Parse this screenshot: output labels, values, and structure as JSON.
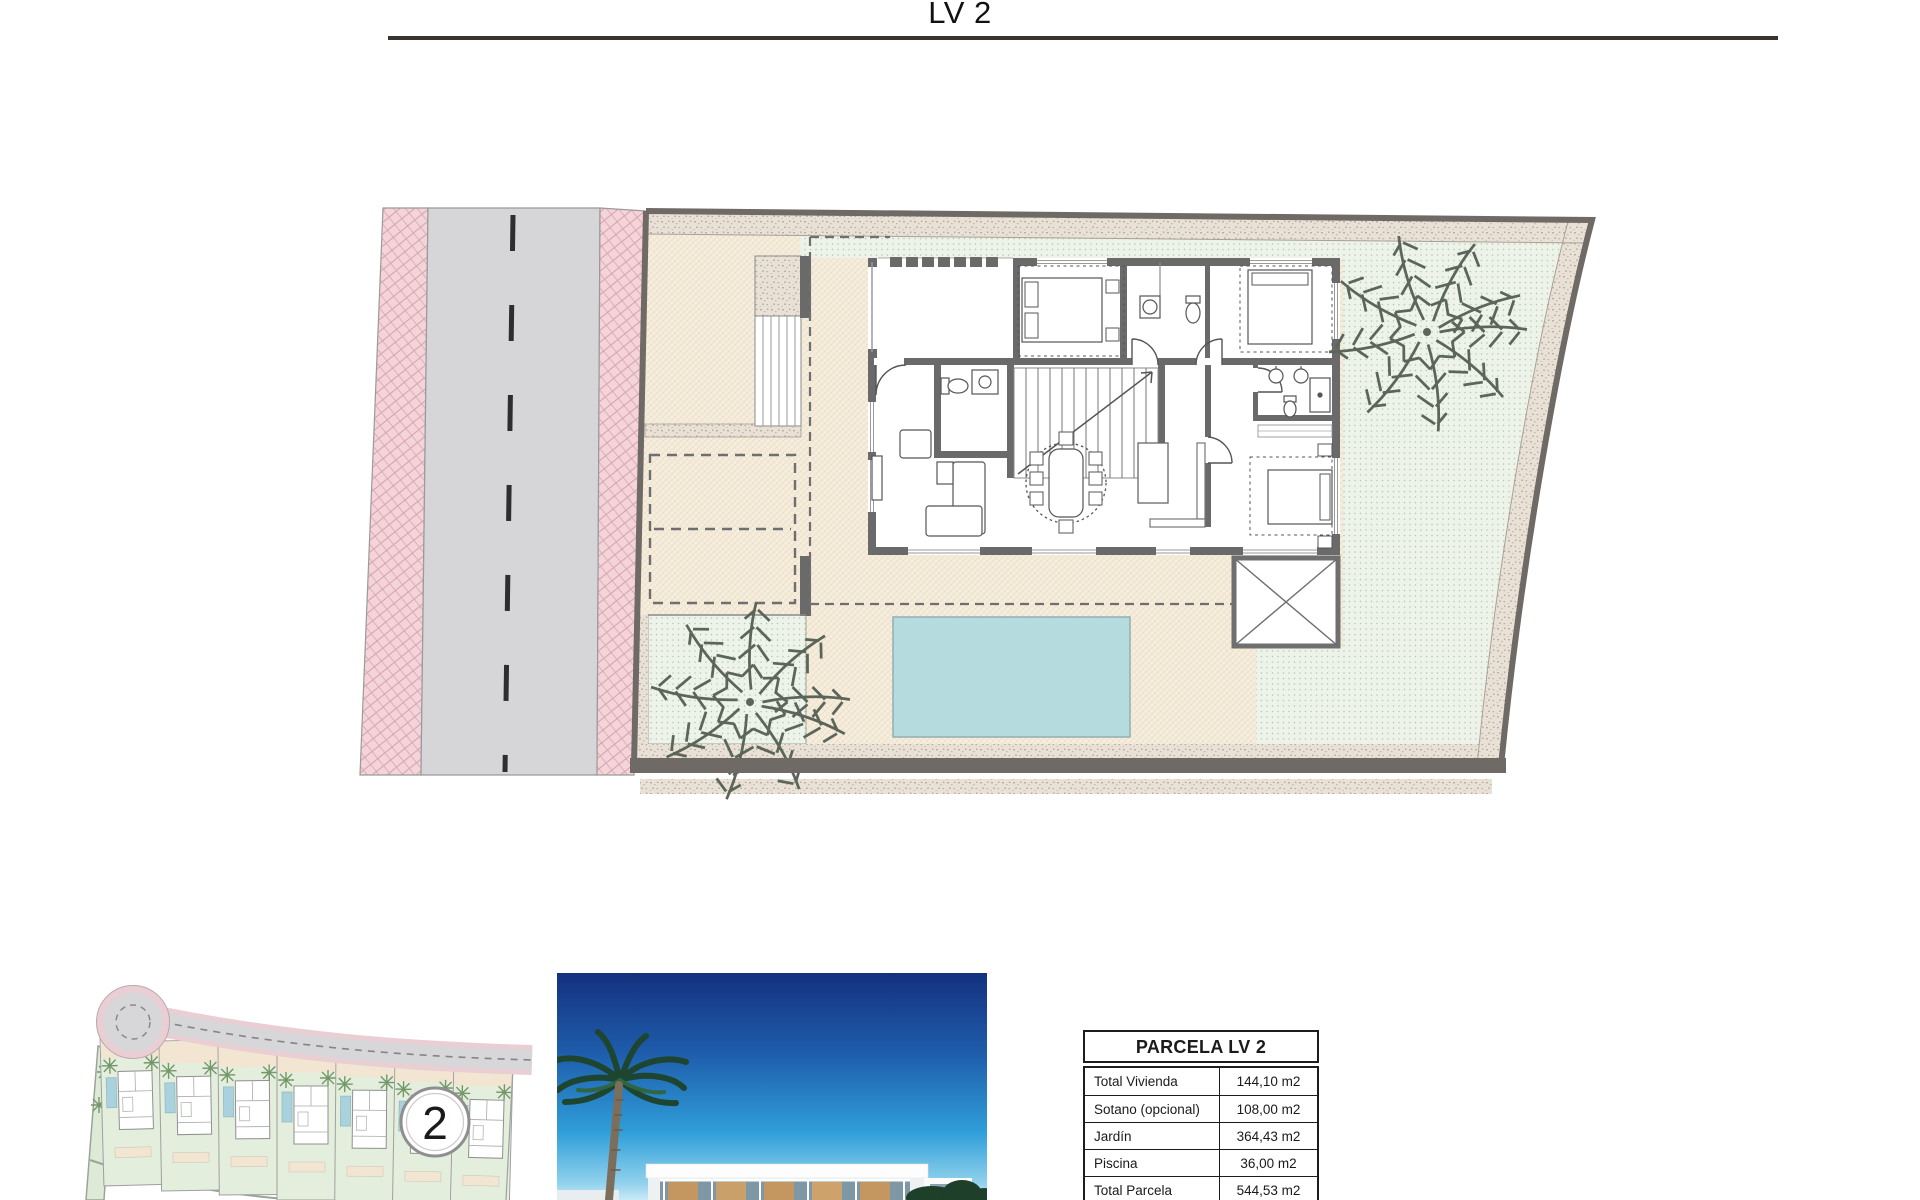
{
  "page": {
    "title": "LV 2"
  },
  "minimap": {
    "badge_label": "2"
  },
  "areas_table": {
    "header": "PARCELA LV 2",
    "rows": [
      {
        "label": "Total Vivienda",
        "value": "144,10 m2"
      },
      {
        "label": "Sotano (opcional)",
        "value": "108,00 m2"
      },
      {
        "label": "Jardín",
        "value": "364,43 m2"
      },
      {
        "label": "Piscina",
        "value": "36,00 m2"
      },
      {
        "label": "Total Parcela",
        "value": "544,53 m2"
      }
    ]
  },
  "colors": {
    "title_rule": "#3a342e",
    "road_gray": "#d6d6d8",
    "sidewalk_pink": "#f4d3d9",
    "terrace_beige": "#f6eddd",
    "lawn_green": "#edf3e9",
    "gravel": "#e9e1d6",
    "wall_gray": "#6a6a6a",
    "pool_blue": "#b5dbdf",
    "sky_top": "#14317e",
    "sky_bottom": "#c9e9f6"
  }
}
